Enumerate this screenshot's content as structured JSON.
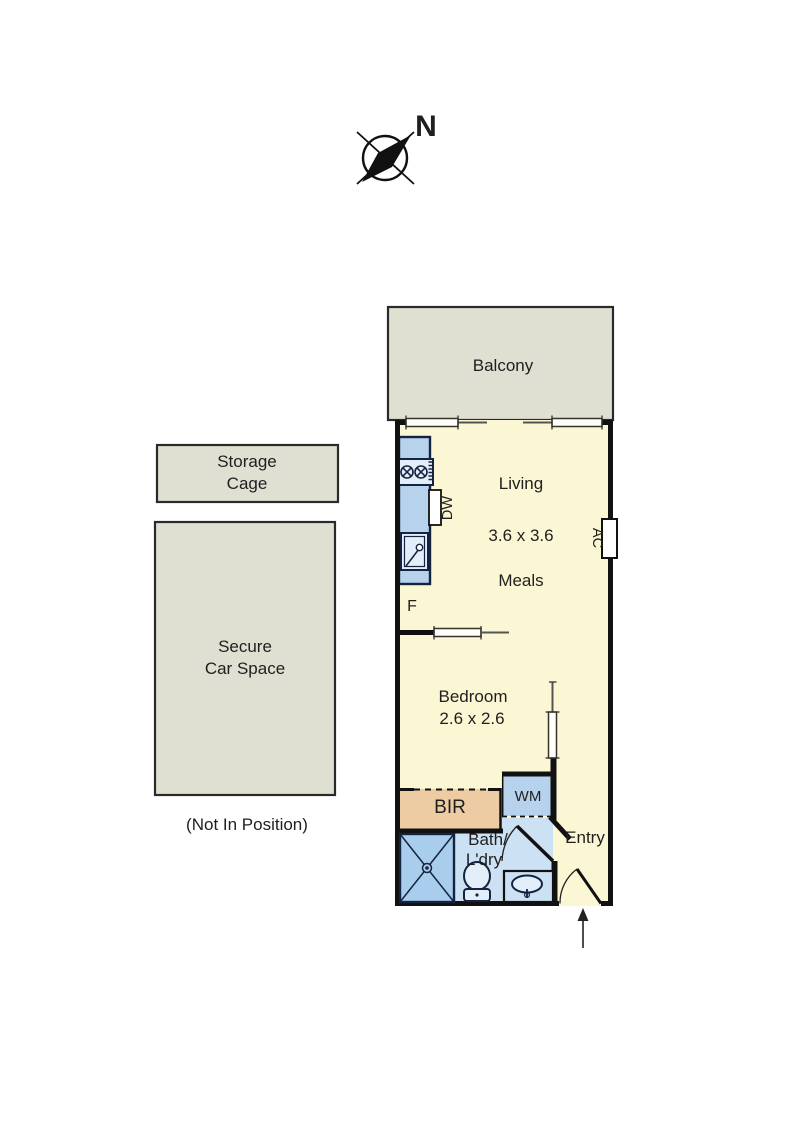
{
  "colors": {
    "floor": "#fbf6d3",
    "outdoor": "#dfdfd2",
    "fixture_blue": "#b7d2ec",
    "bath_floor": "#cde1f4",
    "fixture_light": "#e3eefb",
    "shower": "#a9cdec",
    "robe_tan": "#edcba3",
    "fixture_stroke": "#14233f",
    "wall": "#111111"
  },
  "compass": {
    "north": "N"
  },
  "outdoor": {
    "balcony": "Balcony",
    "storage_line1": "Storage",
    "storage_line2": "Cage",
    "carspace_line1": "Secure",
    "carspace_line2": "Car Space",
    "carspace_note": "(Not In Position)"
  },
  "rooms": {
    "living": "Living",
    "living_dim": "3.6 x 3.6",
    "meals": "Meals",
    "bedroom": "Bedroom",
    "bedroom_dim": "2.6 x 2.6",
    "bath_line1": "Bath/",
    "bath_line2": "L'dry",
    "entry": "Entry"
  },
  "fixtures": {
    "dishwasher": "DW",
    "fridge": "F",
    "air_conditioner": "AC",
    "washing_machine": "WM",
    "built_in_robe": "BIR"
  }
}
